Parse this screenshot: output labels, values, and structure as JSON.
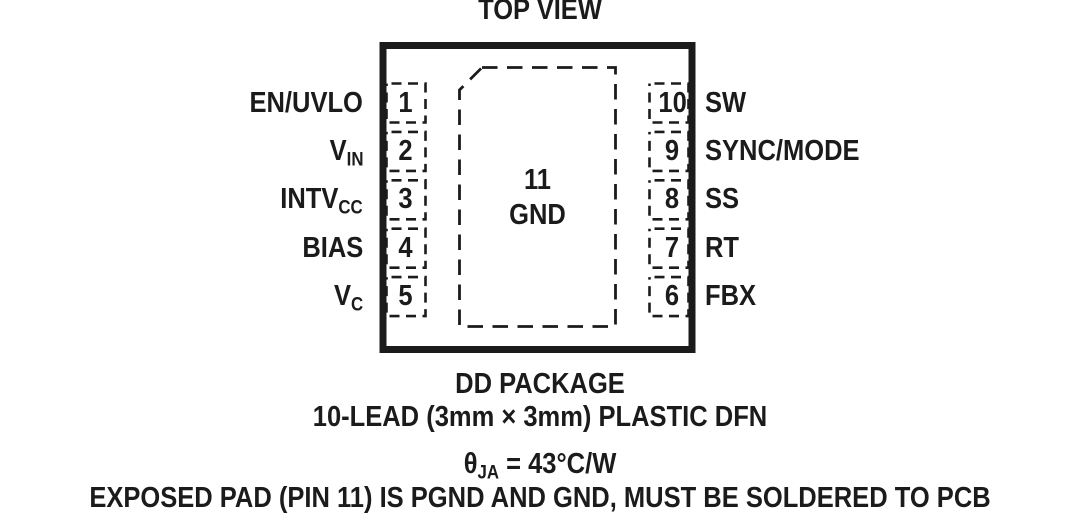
{
  "title": "TOP VIEW",
  "colors": {
    "ink": "#1b1b1b",
    "background": "#ffffff"
  },
  "package": {
    "left_pins": [
      {
        "number": "1",
        "name_main": "EN/UVLO",
        "name_sub": ""
      },
      {
        "number": "2",
        "name_main": "V",
        "name_sub": "IN"
      },
      {
        "number": "3",
        "name_main": "INTV",
        "name_sub": "CC"
      },
      {
        "number": "4",
        "name_main": "BIAS",
        "name_sub": ""
      },
      {
        "number": "5",
        "name_main": "V",
        "name_sub": "C"
      }
    ],
    "right_pins": [
      {
        "number": "10",
        "name_main": "SW",
        "name_sub": ""
      },
      {
        "number": "9",
        "name_main": "SYNC/MODE",
        "name_sub": ""
      },
      {
        "number": "8",
        "name_main": "SS",
        "name_sub": ""
      },
      {
        "number": "7",
        "name_main": "RT",
        "name_sub": ""
      },
      {
        "number": "6",
        "name_main": "FBX",
        "name_sub": ""
      }
    ],
    "exposed_pad": {
      "number": "11",
      "label": "GND"
    }
  },
  "footer": {
    "package_name": "DD PACKAGE",
    "package_desc": "10-LEAD (3mm × 3mm) PLASTIC DFN",
    "theta_symbol": "θ",
    "theta_sub": "JA",
    "theta_value": " = 43°C/W",
    "exposed_pad_note": "EXPOSED PAD (PIN 11) IS PGND AND GND, MUST BE SOLDERED TO PCB"
  }
}
